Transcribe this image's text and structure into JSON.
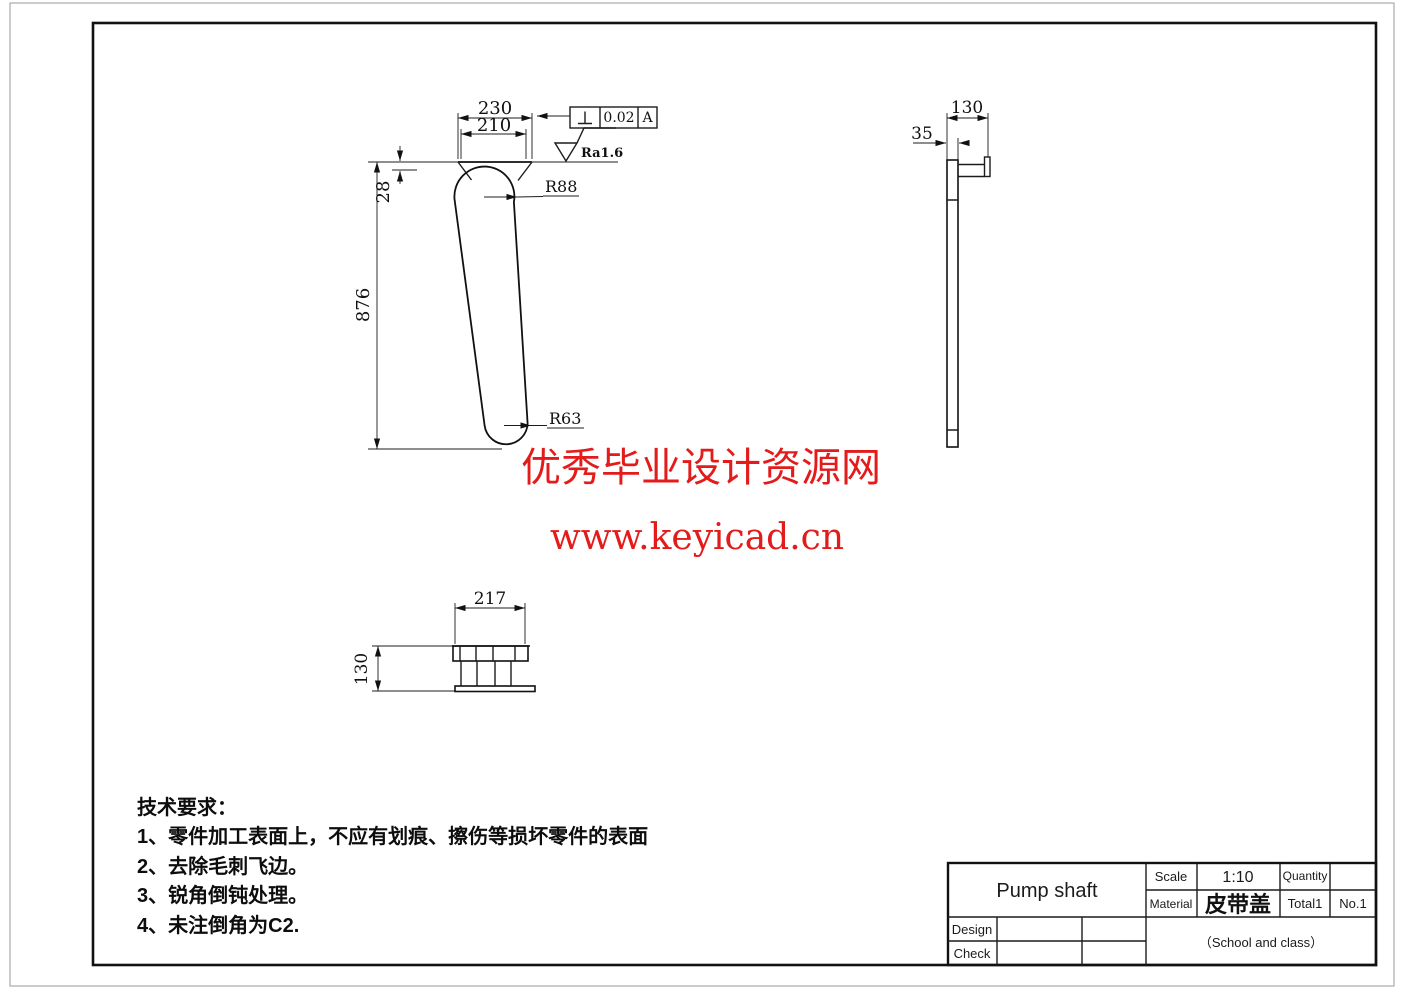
{
  "watermark": {
    "line1": "优秀毕业设计资源网",
    "line2": "www.keyicad.cn",
    "color": "#e41b1b"
  },
  "tech_requirements": {
    "title": "技术要求：",
    "items": [
      "1、零件加工表面上，不应有划痕、擦伤等损坏零件的表面",
      "2、去除毛刺飞边。",
      "3、锐角倒钝处理。",
      "4、未注倒角为C2."
    ]
  },
  "front_view": {
    "dim_230": "230",
    "dim_210": "210",
    "dim_28": "28",
    "dim_876": "876",
    "radius_top": "R88",
    "radius_bottom": "R63"
  },
  "side_view": {
    "dim_130": "130",
    "dim_35": "35"
  },
  "bottom_view": {
    "dim_217": "217",
    "dim_130": "130"
  },
  "tolerance": {
    "value": "0.02",
    "datum": "A"
  },
  "surface_finish": {
    "label": "Ra1.6"
  },
  "title_block": {
    "part_name": "Pump shaft",
    "scale_label": "Scale",
    "scale_value": "1:10",
    "quantity_label": "Quantity",
    "material_label": "Material",
    "material_value": "皮带盖",
    "total_label": "Total1",
    "sheet_no": "No.1",
    "design_label": "Design",
    "check_label": "Check",
    "school_label": "（School and class）"
  }
}
